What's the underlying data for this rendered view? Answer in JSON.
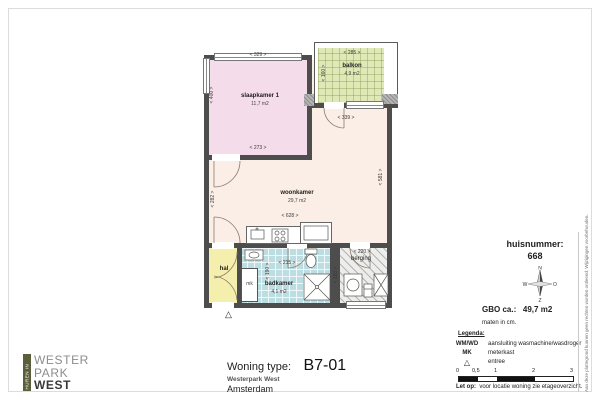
{
  "colors": {
    "wall": "#4d4d4d",
    "slaapkamer": "#f4dcea",
    "woonkamer": "#faeee6",
    "hal": "#f5efad",
    "badkamer": "#bcdde1",
    "balkon": "#dfe9b8",
    "berging": "#ededeb",
    "logo_green": "#5a5e3a"
  },
  "plan": {
    "rooms": {
      "slaapkamer": {
        "label": "slaapkamer 1",
        "area": "11,7 m2"
      },
      "woonkamer": {
        "label": "woonkamer",
        "area": "29,7 m2"
      },
      "balkon": {
        "label": "balkon",
        "area": "4,9 m2"
      },
      "badkamer": {
        "label": "badkamer",
        "area": "4,1 m2"
      },
      "hal": {
        "label": "hal"
      },
      "berging": {
        "label": "berging"
      },
      "mk": {
        "label": "mk"
      }
    },
    "dims": {
      "slaapkamer_top": "< 329 >",
      "slaapkamer_bottom": "< 273 >",
      "slaapkamer_left": "< 400 >",
      "balkon_top": "< 285 >",
      "balkon_side": "< 160 >",
      "balkondeur": "< 339 >",
      "woonkamer_left": "< 282 >",
      "woonkamer_right": "< 581 >",
      "woonkamer_bottom": "< 628 >",
      "badkamer_top": "< 215 >",
      "badkamer_side": "< 190 >",
      "berging_top": "< 220 >",
      "berging_side": "< 183 >"
    },
    "entree_icon": "△"
  },
  "info": {
    "huisnummer_label": "huisnummer:",
    "huisnummer_value": "668",
    "compass": {
      "n": "N",
      "o": "O",
      "z": "Z",
      "w": "W"
    },
    "gbo_label": "GBO ca.:",
    "gbo_value": "49,7 m2",
    "maten": "maten in cm."
  },
  "legend": {
    "title": "Legenda:",
    "items": [
      {
        "key": "WM/WD",
        "desc": "aansluiting wasmachine/wasdroger"
      },
      {
        "key": "MK",
        "desc": "meterkast"
      },
      {
        "key": "△",
        "desc": "entree"
      }
    ],
    "scale_ticks": [
      "0",
      "0,5",
      "1",
      "2",
      "3"
    ],
    "note_label": "Let op:",
    "note_text": "voor locatie woning zie etageoverzicht."
  },
  "title_block": {
    "type_label": "Woning type:",
    "type_value": "B7-01",
    "project": "Westerpark West",
    "city": "Amsterdam"
  },
  "logo": {
    "side": "HUREN IN",
    "line1": "WESTER",
    "line2": "PARK",
    "line3": "WEST"
  },
  "disclaimer": "Aan deze plattegrond kunnen geen rechten worden ontleend. Wijzigingen voorbehouden."
}
